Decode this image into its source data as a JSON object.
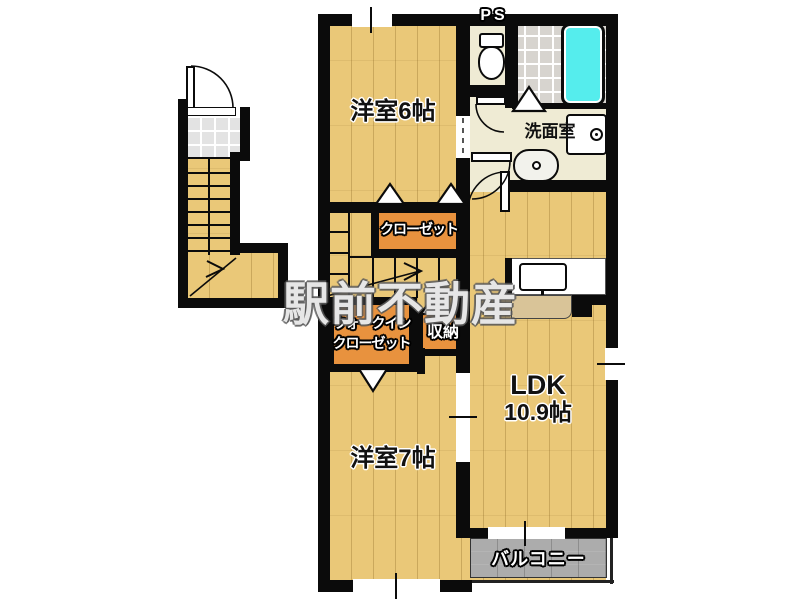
{
  "watermark": "駅前不動産",
  "rooms": {
    "bedroom6": "洋室6帖",
    "bedroom7": "洋室7帖",
    "ldk_line1": "LDK",
    "ldk_line2": "10.9帖",
    "washroom": "洗面室",
    "closet": "クローゼット",
    "wic_line1": "ウォークイン",
    "wic_line2": "クローゼット",
    "storage": "収納",
    "balcony": "バルコニー",
    "pipe_space": "PS"
  },
  "colors": {
    "wall": "#0b0b0b",
    "wood_floor": "#eac878",
    "closet_orange": "#e8923e",
    "washroom_cream": "#efebd4",
    "bathtub_cyan": "#55eded",
    "balcony_gray": "#acacac",
    "tile_gray": "#e3e3e3"
  }
}
